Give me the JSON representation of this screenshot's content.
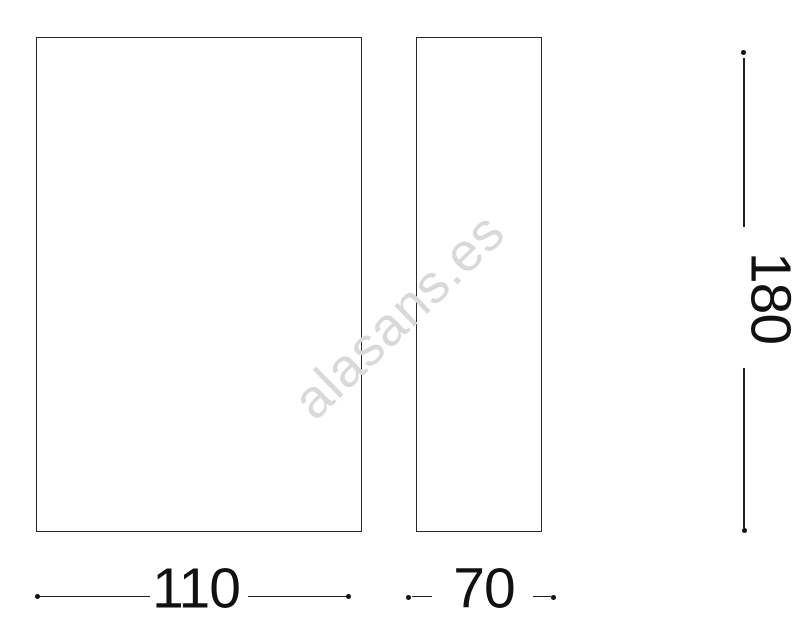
{
  "drawing": {
    "watermark_text": "alasans.es",
    "dimensions": {
      "width": "110",
      "depth": "70",
      "height": "180"
    },
    "colors": {
      "line": "#1e1e1e",
      "text": "#111111",
      "watermark": "#d9d9d9",
      "background": "#ffffff"
    }
  }
}
